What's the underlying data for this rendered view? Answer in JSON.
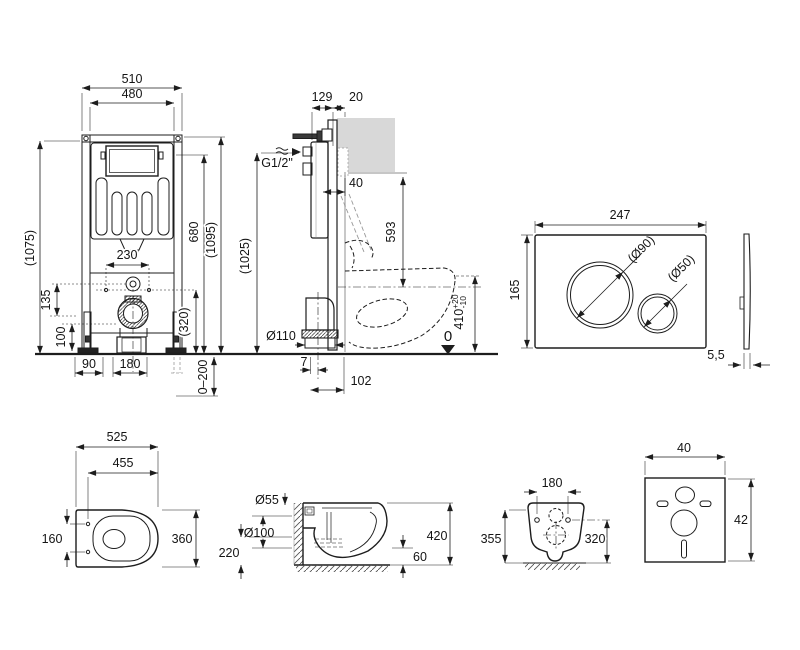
{
  "drawing_title": "Wall-hung WC installation set dimensional drawing",
  "frame_front": {
    "width_outer": "510",
    "width_inner": "480",
    "height_overall": "(1075)",
    "height_680": "680",
    "height_1095": "(1095)",
    "bolt_spacing": "230",
    "dim_135": "135",
    "dim_100": "100",
    "height_320": "(320)",
    "dim_90": "90",
    "dim_180": "180",
    "adjust_range": "0–200"
  },
  "frame_side": {
    "depth_129": "129",
    "tile_20": "20",
    "supply": "G1/2\"",
    "offset_40": "40",
    "height_593": "593",
    "height_1025": "(1025)",
    "drain_dia": "Ø110",
    "offset_7": "7",
    "offset_102": "102",
    "seat_height": "410",
    "tol_plus": "+20",
    "tol_minus": "-10",
    "datum_zero": "0"
  },
  "flush_plate": {
    "width": "247",
    "height": "165",
    "dia_big": "(Ø90)",
    "dia_small": "(Ø50)",
    "thickness": "5,5"
  },
  "wc_top": {
    "length": "525",
    "depth_455": "455",
    "hole_spacing": "160",
    "width": "360"
  },
  "wc_side": {
    "inlet_dia": "Ø55",
    "drain_dia": "Ø100",
    "drain_height": "220",
    "height": "420",
    "clearance": "60"
  },
  "wc_rear": {
    "hole_spacing": "180",
    "height_left": "355",
    "height_right": "320"
  },
  "pad": {
    "width": "40",
    "height": "42"
  }
}
